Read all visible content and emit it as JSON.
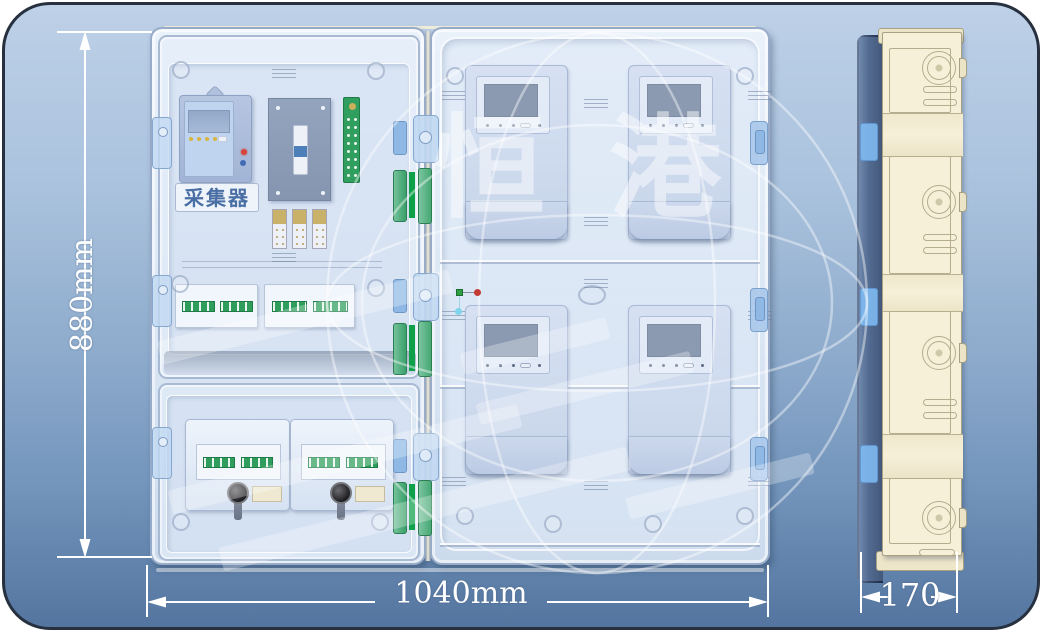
{
  "image_type": "technical product rendering of an electric meter box",
  "front_view": {
    "collector_label": "采集器",
    "meter_count": 4,
    "door_panels": 2,
    "hinge_rows": 3
  },
  "dimensions": {
    "height_label": "880mm",
    "width_label": "1040mm",
    "depth_label": "170"
  },
  "watermark": {
    "char_left": "恒",
    "char_right": "港"
  },
  "colors": {
    "background_top": "#bdd0e7",
    "background_bottom": "#54759f",
    "card_border": "#26303e",
    "enclosure_shell": "#e4edf8",
    "side_body_cream": "#f6f0d9",
    "hinge_green": "#0ea14a",
    "terminal_green": "#2f9e5c",
    "latch_blue": "#8fb9e4",
    "meter_screen": "#8b9ab1",
    "led_red": "#d6453a",
    "led_blue": "#3f6cb4",
    "led_yellow": "#d8b440",
    "dimension_text": "#ffffff",
    "collector_text": "#4a6fa5"
  }
}
